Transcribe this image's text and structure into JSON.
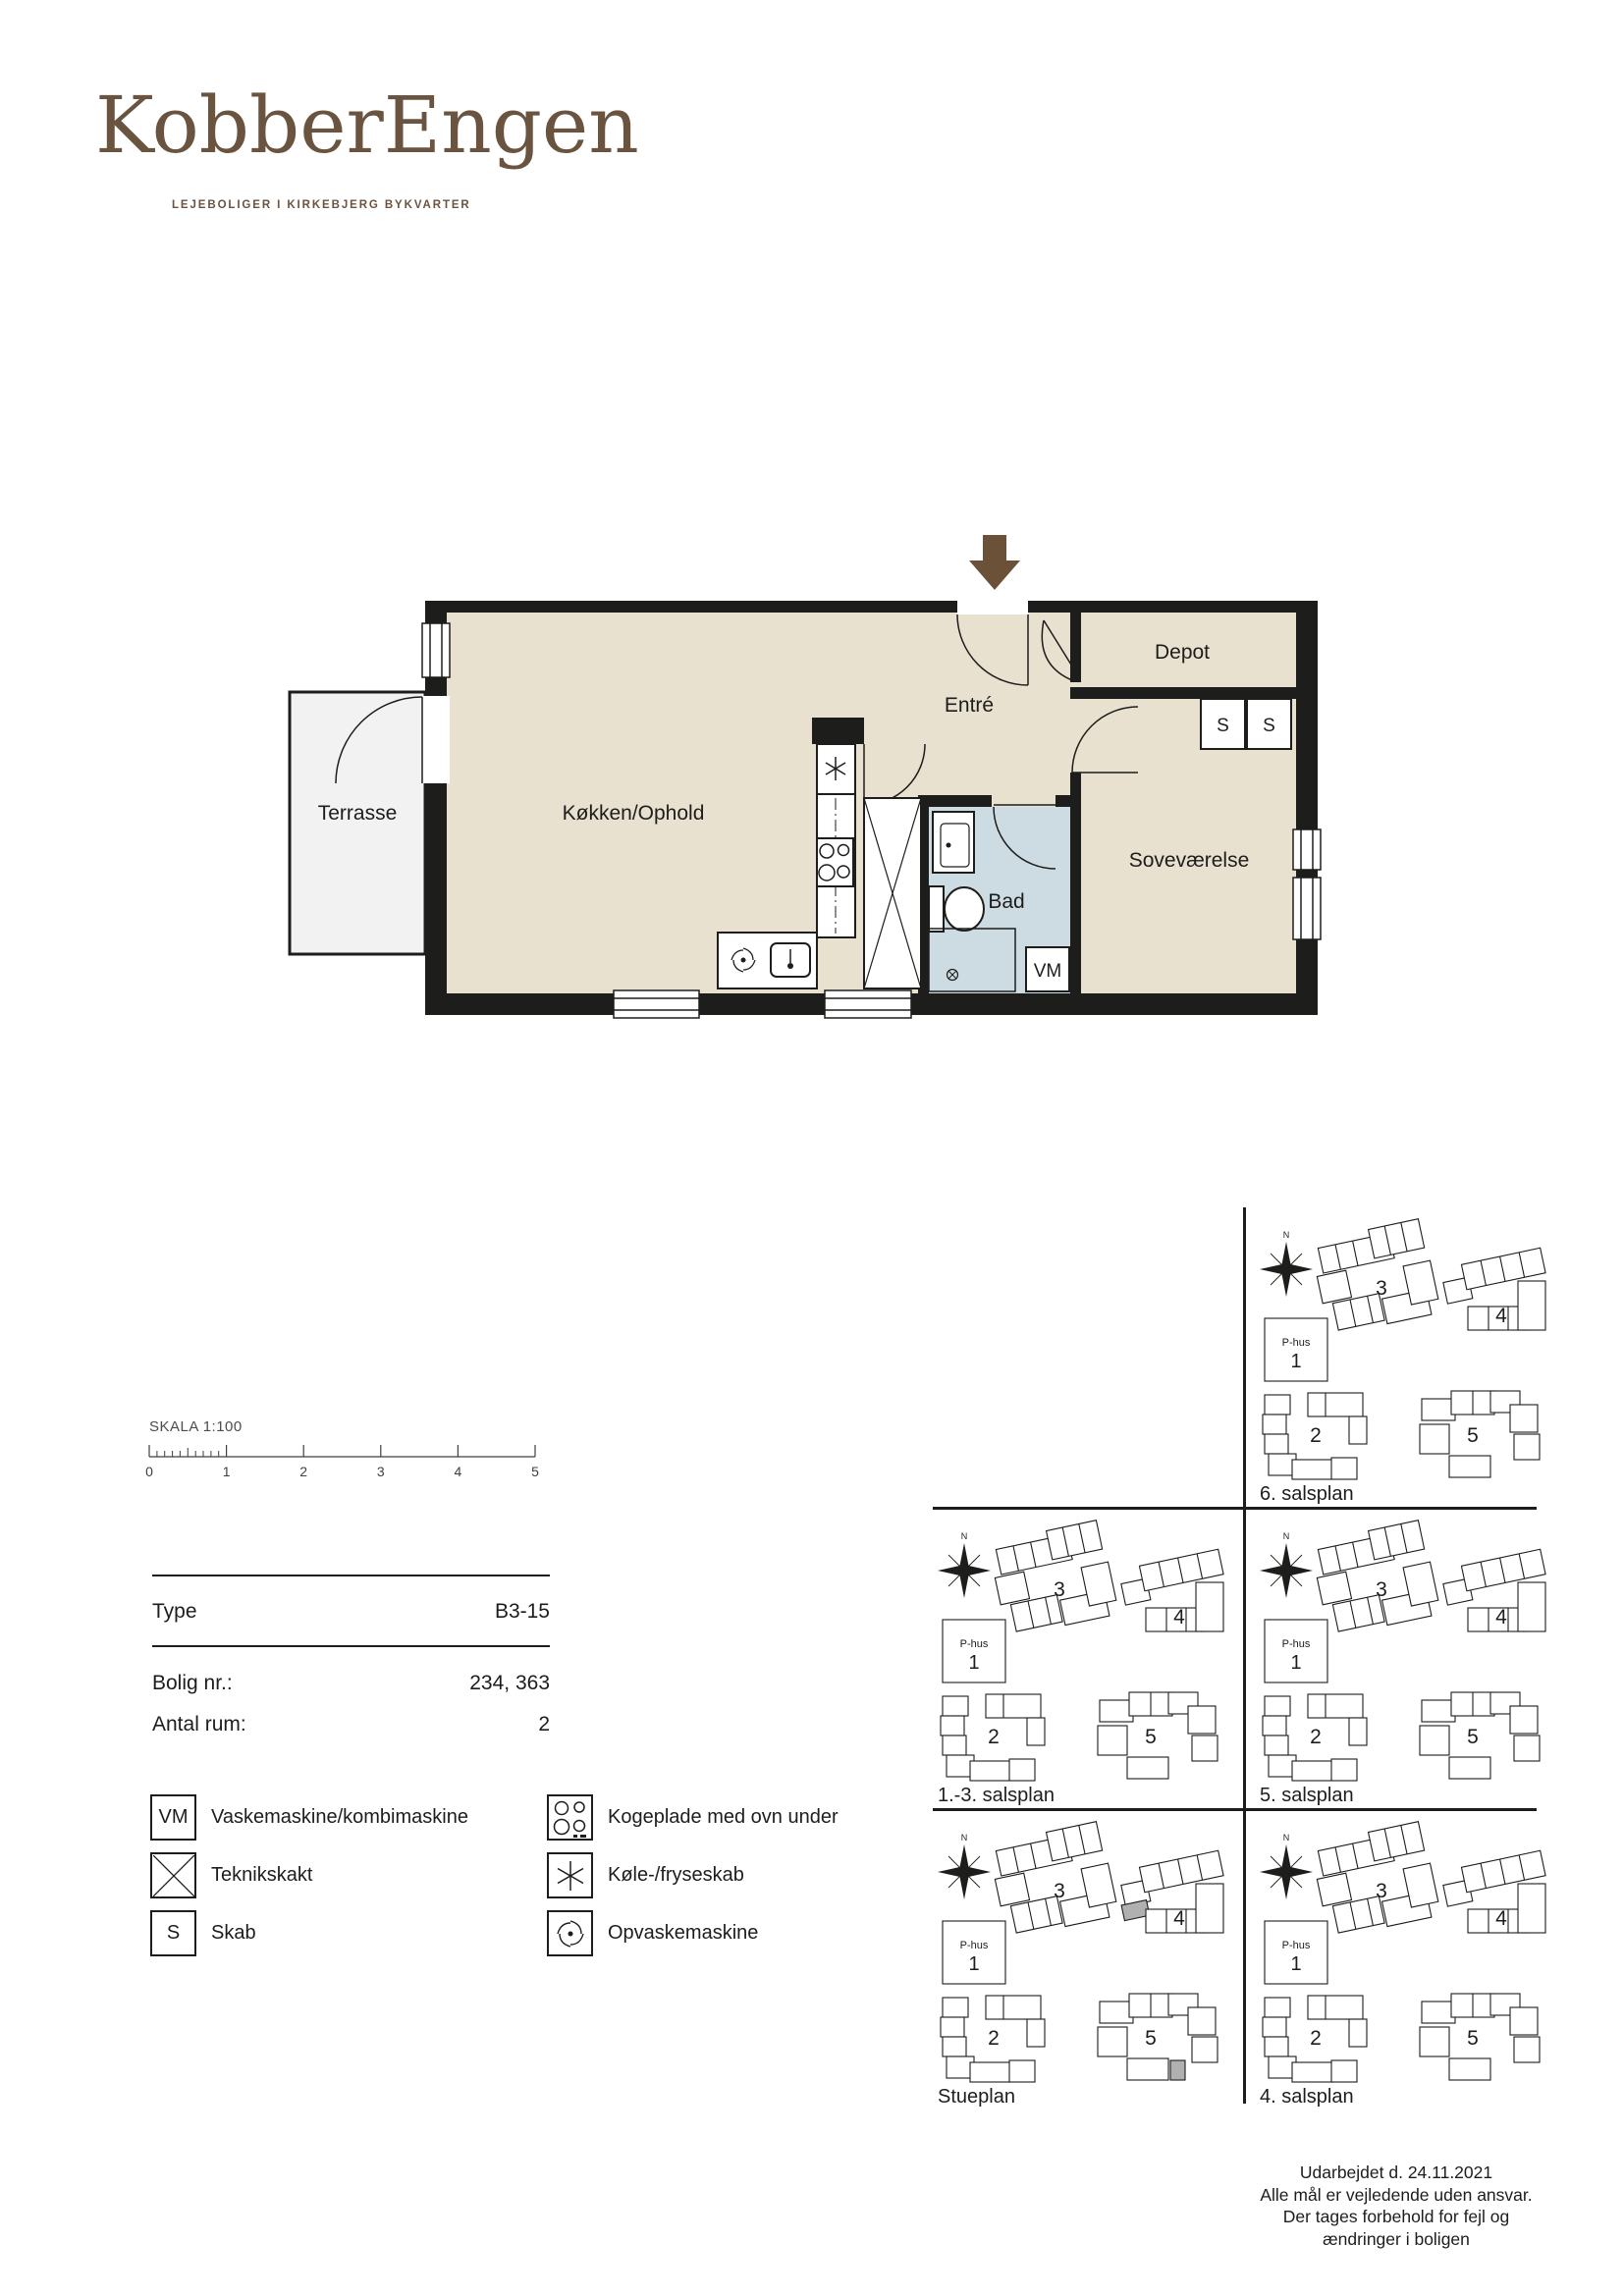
{
  "brand": {
    "name": "KobberEngen",
    "tagline": "LEJEBOLIGER I KIRKEBJERG BYKVARTER"
  },
  "floorplan": {
    "rooms": {
      "terrace": "Terrasse",
      "kitchen_living": "Køkken/Ophold",
      "entry": "Entré",
      "storage": "Depot",
      "bath": "Bad",
      "bedroom": "Soveværelse"
    },
    "markers": {
      "cabinet1": "S",
      "cabinet2": "S",
      "washer": "VM"
    }
  },
  "scalebar": {
    "label": "SKALA 1:100",
    "ticks": [
      "0",
      "1",
      "2",
      "3",
      "4",
      "5"
    ]
  },
  "info_table": {
    "rows": [
      {
        "label": "Type",
        "value": "B3-15"
      },
      {
        "label": "Bolig nr.:",
        "value": "234, 363"
      },
      {
        "label": "Antal rum:",
        "value": "2"
      }
    ]
  },
  "legend": {
    "items_left": [
      {
        "symbol": "VM",
        "label": "Vaskemaskine/kombimaskine"
      },
      {
        "symbol": "X",
        "label": "Teknikskakt"
      },
      {
        "symbol": "S",
        "label": "Skab"
      }
    ],
    "items_right": [
      {
        "symbol": "stove",
        "label": "Kogeplade med ovn under"
      },
      {
        "symbol": "fridge",
        "label": "Køle-/fryseskab"
      },
      {
        "symbol": "dishwasher",
        "label": "Opvaskemaskine"
      }
    ]
  },
  "siteplans": {
    "compass": "N",
    "phus_label": "P-hus",
    "buildings": {
      "b1": "1",
      "b2": "2",
      "b3": "3",
      "b4": "4",
      "b5": "5"
    },
    "panels": [
      {
        "label": "6. salsplan",
        "highlighted": false
      },
      {
        "label": "1.-3. salsplan",
        "highlighted": false
      },
      {
        "label": "5. salsplan",
        "highlighted": false
      },
      {
        "label": "Stueplan",
        "highlighted": true
      },
      {
        "label": "4. salsplan",
        "highlighted": false
      }
    ]
  },
  "footer": {
    "lines": [
      "Udarbejdet d. 24.11.2021",
      "Alle mål er vejledende uden ansvar.",
      "Der tages forbehold for fejl og",
      "ændringer i boligen"
    ]
  },
  "colors": {
    "wall": "#1d1d1b",
    "floor": "#e9e1d0",
    "bath": "#cddce3",
    "terrace": "#f2f2f2",
    "brand": "#6a5440",
    "arrow": "#6b5138",
    "highlight": "#b0b0b0"
  }
}
